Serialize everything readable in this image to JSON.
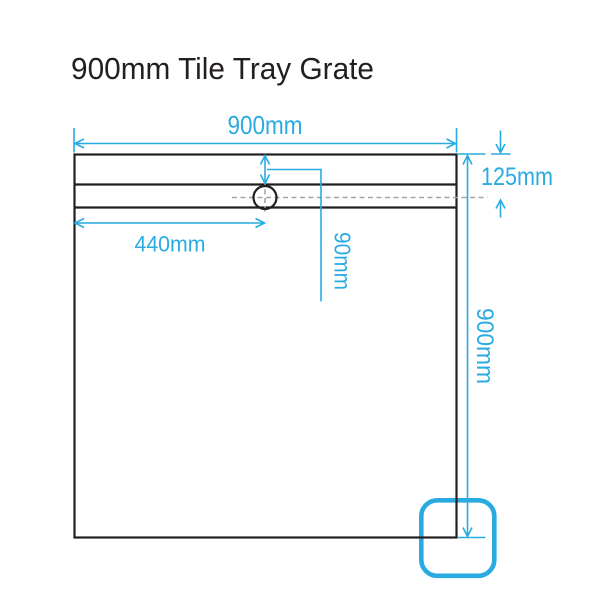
{
  "title": "900mm Tile Tray Grate",
  "diagram": {
    "type": "technical-dimension-drawing",
    "subject": "shower tile tray with linear grate and drain hole",
    "dimensions": {
      "width_top": "900mm",
      "top_edge_to_drain_centerline": "125mm",
      "left_edge_to_drain_hole": "440mm",
      "top_edge_to_grate_channel": "90mm",
      "height_right": "900mm"
    },
    "colors": {
      "dimension_lines": "#29ABE2",
      "outline": "#231F20",
      "centerline_dashes": "#A2A4A7",
      "corner_highlight": "#29ABE2",
      "background": "#FFFFFF"
    }
  }
}
